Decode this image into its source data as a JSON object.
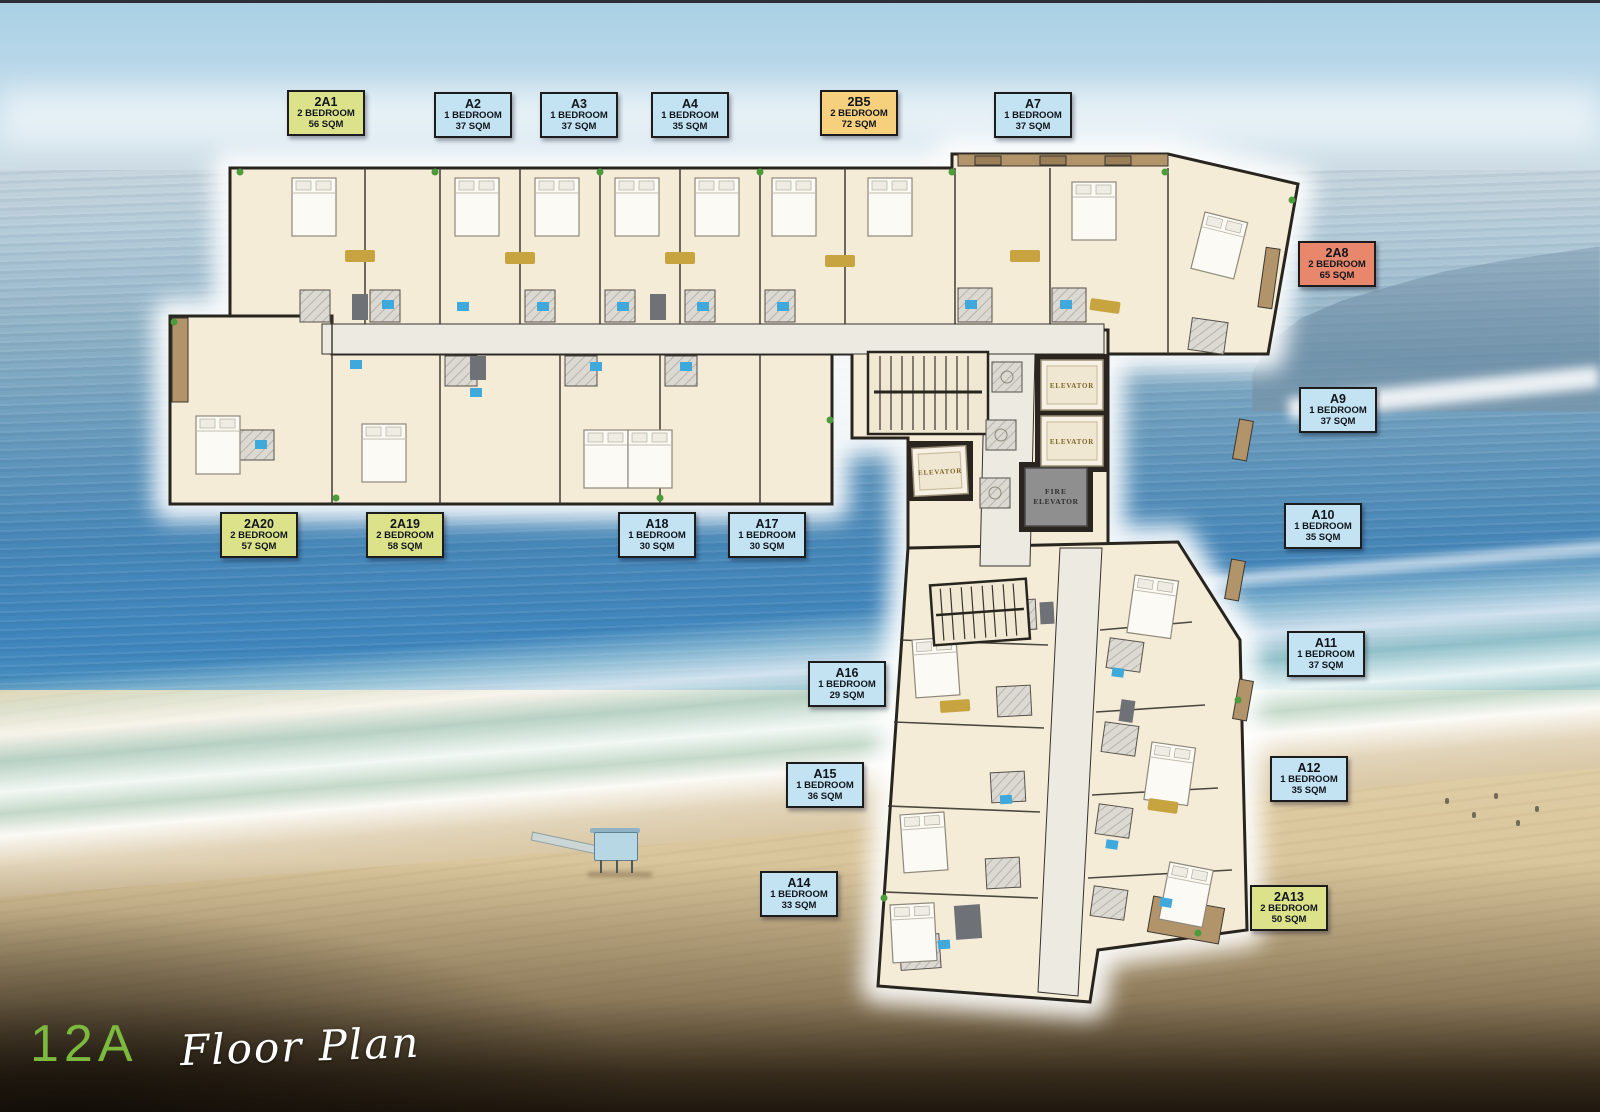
{
  "page": {
    "floor": "12A",
    "title_script": "Floor Plan"
  },
  "palette": {
    "badge_green": "#dce289",
    "badge_blue": "#c3e2f2",
    "badge_orange": "#f6d07c",
    "badge_salmon": "#e8876b",
    "badge_border": "#1c1c1c",
    "badge_text": "#10151c",
    "floor_number_green": "#7cb93e"
  },
  "plan_labels": {
    "elevator": "ELEVATOR",
    "fire": "FIRE"
  },
  "units": [
    {
      "id": "2A1",
      "type": "2 BEDROOM",
      "area": "56 SQM",
      "color": "green"
    },
    {
      "id": "A2",
      "type": "1 BEDROOM",
      "area": "37 SQM",
      "color": "blue"
    },
    {
      "id": "A3",
      "type": "1 BEDROOM",
      "area": "37 SQM",
      "color": "blue"
    },
    {
      "id": "A4",
      "type": "1 BEDROOM",
      "area": "35 SQM",
      "color": "blue"
    },
    {
      "id": "2B5",
      "type": "2 BEDROOM",
      "area": "72 SQM",
      "color": "orange"
    },
    {
      "id": "A7",
      "type": "1 BEDROOM",
      "area": "37 SQM",
      "color": "blue"
    },
    {
      "id": "2A8",
      "type": "2 BEDROOM",
      "area": "65 SQM",
      "color": "salmon"
    },
    {
      "id": "A9",
      "type": "1 BEDROOM",
      "area": "37 SQM",
      "color": "blue"
    },
    {
      "id": "A10",
      "type": "1 BEDROOM",
      "area": "35 SQM",
      "color": "blue"
    },
    {
      "id": "A11",
      "type": "1 BEDROOM",
      "area": "37 SQM",
      "color": "blue"
    },
    {
      "id": "A12",
      "type": "1 BEDROOM",
      "area": "35 SQM",
      "color": "blue"
    },
    {
      "id": "2A13",
      "type": "2 BEDROOM",
      "area": "50 SQM",
      "color": "green"
    },
    {
      "id": "A14",
      "type": "1 BEDROOM",
      "area": "33 SQM",
      "color": "blue"
    },
    {
      "id": "A15",
      "type": "1 BEDROOM",
      "area": "36 SQM",
      "color": "blue"
    },
    {
      "id": "A16",
      "type": "1 BEDROOM",
      "area": "29 SQM",
      "color": "blue"
    },
    {
      "id": "A17",
      "type": "1 BEDROOM",
      "area": "30 SQM",
      "color": "blue"
    },
    {
      "id": "A18",
      "type": "1 BEDROOM",
      "area": "30 SQM",
      "color": "blue"
    },
    {
      "id": "2A19",
      "type": "2 BEDROOM",
      "area": "58 SQM",
      "color": "green"
    },
    {
      "id": "2A20",
      "type": "2 BEDROOM",
      "area": "57 SQM",
      "color": "green"
    }
  ]
}
